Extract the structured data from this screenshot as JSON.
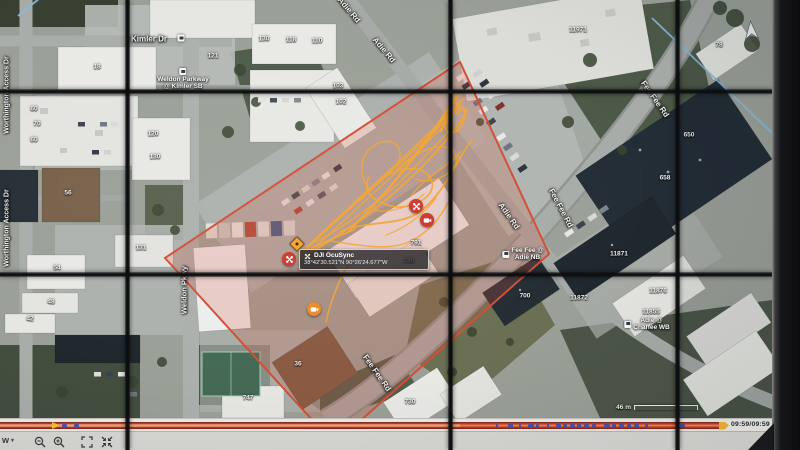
{
  "colors": {
    "zone_stroke": "#e5492e",
    "zone_fill": "rgba(231,76,52,0.22)",
    "flight_path_orange": "#ffa21e",
    "marker_red": "#e03325",
    "marker_orange": "#f58a1d",
    "timeline_red": "#d9472b",
    "timeline_marker_blue": "#2f50d0",
    "play_marker_yellow": "#ffc21c",
    "sector_line_blue": "#7cbce8"
  },
  "map": {
    "infobox": {
      "title": "DJI OcuSync",
      "coordinates": "38°42'30.521\"N 90°26'24.677\"W"
    },
    "scale_label": "46 m",
    "streets": [
      {
        "label": "Kimler Dr",
        "x": 149,
        "y": 39,
        "rot": 0,
        "size": 8
      },
      {
        "label": "Worthington Access Dr",
        "x": 7,
        "y": 95,
        "rot": -90,
        "size": 7
      },
      {
        "label": "Worthington Access Dr",
        "x": 7,
        "y": 228,
        "rot": -90,
        "size": 7
      },
      {
        "label": "Weldon Pkwy",
        "x": 184,
        "y": 290,
        "rot": -90,
        "size": 7.5
      },
      {
        "label": "Adie Rd",
        "x": 349,
        "y": 10,
        "rot": 50,
        "size": 8
      },
      {
        "label": "Adie Rd",
        "x": 384,
        "y": 50,
        "rot": 50,
        "size": 8
      },
      {
        "label": "Adie Rd",
        "x": 509,
        "y": 216,
        "rot": 55,
        "size": 8
      },
      {
        "label": "Fee Fee Rd",
        "x": 655,
        "y": 99,
        "rot": 55,
        "size": 8
      },
      {
        "label": "Fee Fee Rd",
        "x": 561,
        "y": 208,
        "rot": 62,
        "size": 8
      },
      {
        "label": "Fee Fee Rd",
        "x": 377,
        "y": 373,
        "rot": 55,
        "size": 8
      }
    ],
    "transit_stops": [
      {
        "lines": [],
        "x": 181,
        "y": 38,
        "layout": "col"
      },
      {
        "lines": [
          "Weldon Parkway",
          "@ Kimler SB"
        ],
        "x": 183,
        "y": 79,
        "layout": "col"
      },
      {
        "lines": [
          "Fee Fee @",
          "Adie NB"
        ],
        "x": 523,
        "y": 254,
        "layout": "row"
      },
      {
        "lines": [
          "Adie @",
          "Chaffee WB"
        ],
        "x": 647,
        "y": 324,
        "layout": "row"
      }
    ],
    "building_numbers": [
      {
        "label": "121",
        "x": 213,
        "y": 56
      },
      {
        "label": "18",
        "x": 97,
        "y": 67
      },
      {
        "label": "130",
        "x": 264,
        "y": 39
      },
      {
        "label": "118",
        "x": 291,
        "y": 40
      },
      {
        "label": "110",
        "x": 317,
        "y": 41
      },
      {
        "label": "103",
        "x": 338,
        "y": 86
      },
      {
        "label": "102",
        "x": 341,
        "y": 102
      },
      {
        "label": "60",
        "x": 34,
        "y": 109
      },
      {
        "label": "70",
        "x": 37,
        "y": 124
      },
      {
        "label": "60",
        "x": 34,
        "y": 140
      },
      {
        "label": "120",
        "x": 153,
        "y": 134
      },
      {
        "label": "130",
        "x": 155,
        "y": 157
      },
      {
        "label": "56",
        "x": 68,
        "y": 193
      },
      {
        "label": "131",
        "x": 141,
        "y": 248
      },
      {
        "label": "54",
        "x": 57,
        "y": 268
      },
      {
        "label": "48",
        "x": 51,
        "y": 302
      },
      {
        "label": "42",
        "x": 30,
        "y": 319
      },
      {
        "label": "36",
        "x": 298,
        "y": 364
      },
      {
        "label": "791",
        "x": 416,
        "y": 243
      },
      {
        "label": "785",
        "x": 409,
        "y": 261
      },
      {
        "label": "747",
        "x": 248,
        "y": 398
      },
      {
        "label": "730",
        "x": 410,
        "y": 402
      },
      {
        "label": "11971",
        "x": 578,
        "y": 30
      },
      {
        "label": "78",
        "x": 719,
        "y": 45
      },
      {
        "label": "650",
        "x": 689,
        "y": 135
      },
      {
        "label": "658",
        "x": 665,
        "y": 178
      },
      {
        "label": "11871",
        "x": 619,
        "y": 254
      },
      {
        "label": "700",
        "x": 525,
        "y": 296
      },
      {
        "label": "11872",
        "x": 579,
        "y": 298
      },
      {
        "label": "11876",
        "x": 658,
        "y": 291
      },
      {
        "label": "11855",
        "x": 651,
        "y": 312
      }
    ],
    "markers": [
      {
        "type": "drone-red",
        "x": 416,
        "y": 206
      },
      {
        "type": "camera-red",
        "x": 427,
        "y": 220
      },
      {
        "type": "drone-red",
        "x": 289,
        "y": 259
      },
      {
        "type": "camera-orange",
        "x": 314,
        "y": 309
      },
      {
        "type": "waypoint-diamond",
        "x": 297,
        "y": 244
      }
    ]
  },
  "timeline": {
    "time_display": "09:59/09:59",
    "event_marks": [
      {
        "x": 62,
        "w": 5
      },
      {
        "x": 74,
        "w": 5
      },
      {
        "x": 496,
        "w": 2
      },
      {
        "x": 508,
        "w": 5
      },
      {
        "x": 519,
        "w": 2
      },
      {
        "x": 528,
        "w": 6
      },
      {
        "x": 536,
        "w": 3
      },
      {
        "x": 547,
        "w": 2
      },
      {
        "x": 556,
        "w": 5
      },
      {
        "x": 563,
        "w": 4
      },
      {
        "x": 570,
        "w": 5
      },
      {
        "x": 577,
        "w": 4
      },
      {
        "x": 584,
        "w": 5
      },
      {
        "x": 592,
        "w": 4
      },
      {
        "x": 604,
        "w": 6
      },
      {
        "x": 612,
        "w": 4
      },
      {
        "x": 619,
        "w": 5
      },
      {
        "x": 627,
        "w": 4
      },
      {
        "x": 634,
        "w": 5
      },
      {
        "x": 645,
        "w": 3
      },
      {
        "x": 680,
        "w": 5
      }
    ]
  },
  "toolbar": {
    "dropdown_label": "w",
    "buttons": [
      "zoom-out",
      "zoom-in",
      "fullscreen",
      "exit-fullscreen"
    ]
  }
}
